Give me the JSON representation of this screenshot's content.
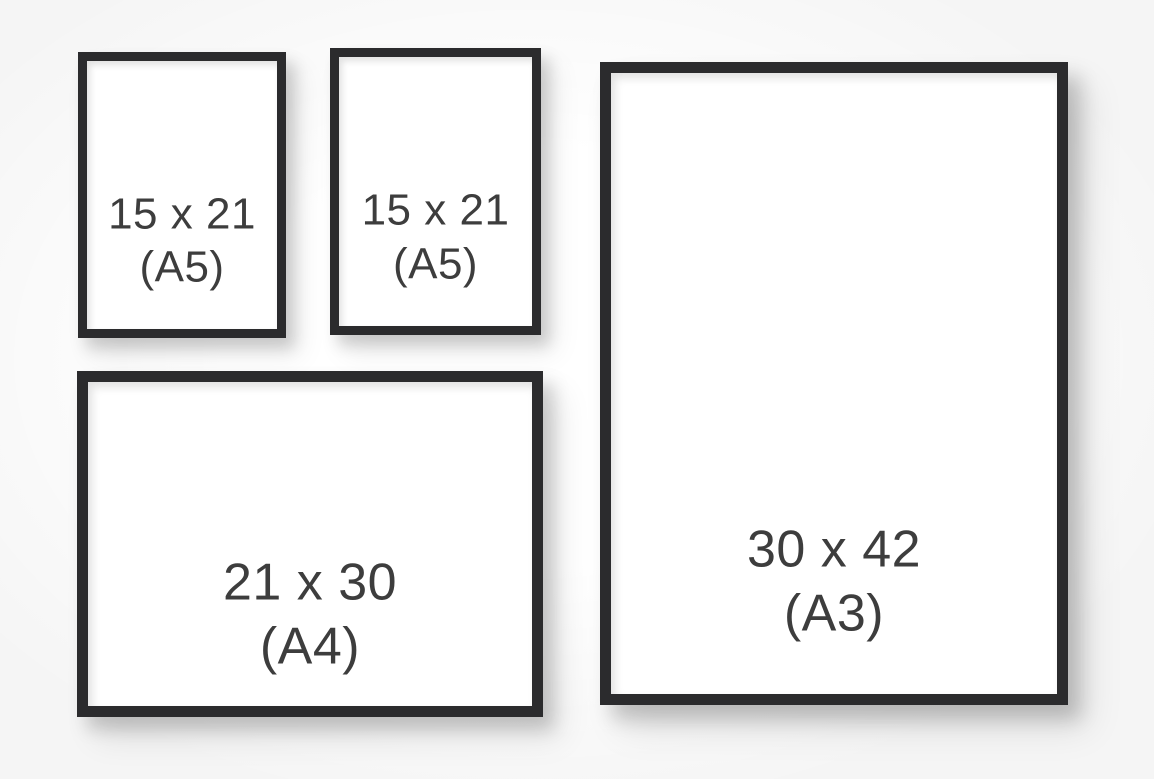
{
  "colors": {
    "frame": "#2b2b2d",
    "text": "#3d3d3d",
    "background": "#f5f5f5"
  },
  "frames": [
    {
      "id": "a5-left",
      "size_label": "15 x 21",
      "format_label": "(A5)",
      "orientation": "portrait"
    },
    {
      "id": "a5-middle",
      "size_label": "15 x 21",
      "format_label": "(A5)",
      "orientation": "portrait"
    },
    {
      "id": "a3-right",
      "size_label": "30 x 42",
      "format_label": "(A3)",
      "orientation": "portrait"
    },
    {
      "id": "a4-bottom",
      "size_label": "21 x 30",
      "format_label": "(A4)",
      "orientation": "landscape"
    }
  ]
}
